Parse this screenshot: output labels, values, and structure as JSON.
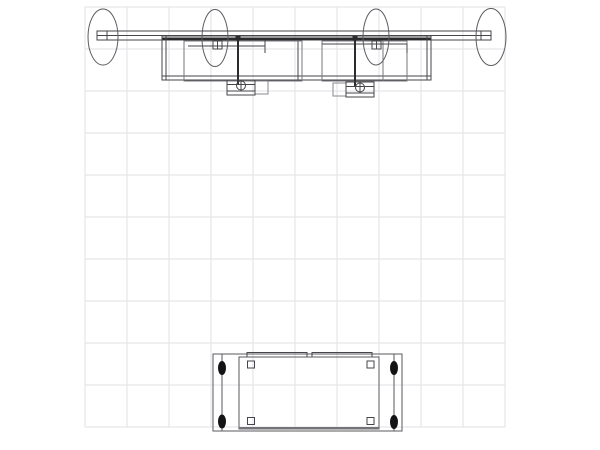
{
  "drawing": {
    "canvas": {
      "width": 600,
      "height": 450,
      "background": "#ffffff"
    },
    "grid": {
      "x0": 85,
      "y0": 7,
      "cols": 10,
      "rows": 10,
      "cell_size": 42,
      "line_color": "#e2e2e6"
    },
    "palette": {
      "default_stroke": "#46464a",
      "mid_stroke": "#5a5a5f",
      "light_stroke": "#8a8a90",
      "dark_fill": "#2b2b2e",
      "bolt_fill": "#131315"
    },
    "shapes": [
      {
        "name": "light-bar-outline",
        "type": "rect",
        "x": 97,
        "y": 31,
        "w": 394,
        "h": 9
      },
      {
        "name": "light-bar-mid-line",
        "type": "line",
        "x1": 97,
        "y1": 35.5,
        "x2": 491,
        "y2": 35.5
      },
      {
        "name": "light-bar-front-band",
        "type": "rect",
        "x": 162,
        "y": 37.4,
        "w": 269,
        "h": 2.4,
        "fill": "#2b2b2e",
        "stroke": "none"
      },
      {
        "name": "bar-end-cap-left",
        "type": "rect",
        "x": 97,
        "y": 31,
        "w": 10,
        "h": 9
      },
      {
        "name": "bar-end-cap-right",
        "type": "rect",
        "x": 481,
        "y": 31,
        "w": 10,
        "h": 9
      },
      {
        "name": "backwall-top-rect",
        "type": "rect",
        "x": 162,
        "y": 36,
        "w": 269,
        "h": 44
      },
      {
        "name": "backwall-left-inner-edge",
        "type": "line",
        "x1": 166,
        "y1": 36,
        "x2": 166,
        "y2": 80
      },
      {
        "name": "backwall-right-inner-edge",
        "type": "line",
        "x1": 427,
        "y1": 36,
        "x2": 427,
        "y2": 80
      },
      {
        "name": "backwall-bottom-inner-edge",
        "type": "line",
        "x1": 162,
        "y1": 76,
        "x2": 431,
        "y2": 76
      },
      {
        "name": "backwall-center-divider",
        "type": "line",
        "x1": 298,
        "y1": 40,
        "x2": 298,
        "y2": 80
      },
      {
        "name": "panel-left",
        "type": "rect",
        "x": 184,
        "y": 41,
        "w": 118,
        "h": 40,
        "stroke": "#77777c"
      },
      {
        "name": "panel-right",
        "type": "rect",
        "x": 322,
        "y": 41,
        "w": 85,
        "h": 40,
        "stroke": "#77777c"
      },
      {
        "name": "panel-right-inner-line",
        "type": "line",
        "x1": 383,
        "y1": 41,
        "x2": 383,
        "y2": 81,
        "stroke": "#77777c"
      },
      {
        "name": "light-arm-left",
        "type": "line",
        "x1": 188,
        "y1": 46,
        "x2": 265,
        "y2": 46
      },
      {
        "name": "light-arm-left-tick",
        "type": "line",
        "x1": 265,
        "y1": 40,
        "x2": 265,
        "y2": 53
      },
      {
        "name": "light-arm-right",
        "type": "line",
        "x1": 322,
        "y1": 44,
        "x2": 407,
        "y2": 44
      },
      {
        "name": "light-arm-right-tick",
        "type": "line",
        "x1": 407,
        "y1": 44,
        "x2": 407,
        "y2": 53
      },
      {
        "name": "bar-clamp-left",
        "type": "rect",
        "x": 213,
        "y": 41,
        "w": 9,
        "h": 8
      },
      {
        "name": "bar-clamp-left-jaw",
        "type": "line",
        "x1": 217.5,
        "y1": 41,
        "x2": 217.5,
        "y2": 49
      },
      {
        "name": "bar-clamp-right",
        "type": "rect",
        "x": 372,
        "y": 41,
        "w": 9,
        "h": 8
      },
      {
        "name": "bar-clamp-right-jaw",
        "type": "line",
        "x1": 376.5,
        "y1": 41,
        "x2": 376.5,
        "y2": 49
      },
      {
        "name": "light-stem-left",
        "type": "line",
        "x1": 238,
        "y1": 36,
        "x2": 238,
        "y2": 85,
        "stroke": "#2b2b2e",
        "sw": 2
      },
      {
        "name": "light-stem-right",
        "type": "line",
        "x1": 355,
        "y1": 36,
        "x2": 355,
        "y2": 87,
        "stroke": "#2b2b2e",
        "sw": 2
      },
      {
        "name": "stem-mount-left",
        "type": "rect",
        "x": 235.5,
        "y": 36,
        "w": 5,
        "h": 4.5,
        "fill": "#2b2b2e",
        "stroke": "none"
      },
      {
        "name": "stem-mount-right",
        "type": "rect",
        "x": 352.5,
        "y": 36,
        "w": 5,
        "h": 4.5,
        "fill": "#2b2b2e",
        "stroke": "none"
      },
      {
        "name": "light-head-left-housing",
        "type": "rect",
        "x": 255,
        "y": 81,
        "w": 13,
        "h": 13,
        "stroke": "#8a8a90"
      },
      {
        "name": "light-head-left-body",
        "type": "rect",
        "x": 227,
        "y": 80,
        "w": 28,
        "h": 15
      },
      {
        "name": "light-head-left-line-top",
        "type": "line",
        "x1": 227,
        "y1": 84.5,
        "x2": 255,
        "y2": 84.5
      },
      {
        "name": "light-head-left-line-bot",
        "type": "line",
        "x1": 227,
        "y1": 91,
        "x2": 255,
        "y2": 91
      },
      {
        "name": "light-head-left-lens",
        "type": "circle",
        "cx": 241,
        "cy": 85.5,
        "r": 4.5
      },
      {
        "name": "light-head-left-pin",
        "type": "line",
        "x1": 241,
        "y1": 81,
        "x2": 241,
        "y2": 90
      },
      {
        "name": "light-head-right-housing",
        "type": "rect",
        "x": 333,
        "y": 83,
        "w": 13,
        "h": 13,
        "stroke": "#8a8a90"
      },
      {
        "name": "light-head-right-body",
        "type": "rect",
        "x": 346,
        "y": 82,
        "w": 28,
        "h": 15
      },
      {
        "name": "light-head-right-line-top",
        "type": "line",
        "x1": 346,
        "y1": 86.5,
        "x2": 374,
        "y2": 86.5
      },
      {
        "name": "light-head-right-line-bot",
        "type": "line",
        "x1": 346,
        "y1": 93,
        "x2": 374,
        "y2": 93
      },
      {
        "name": "light-head-right-lens",
        "type": "circle",
        "cx": 360,
        "cy": 87.5,
        "r": 4.5
      },
      {
        "name": "light-head-right-pin",
        "type": "line",
        "x1": 360,
        "y1": 83,
        "x2": 360,
        "y2": 92
      },
      {
        "name": "light-ellipse-1",
        "type": "ellipse",
        "cx": 103,
        "cy": 37,
        "rx": 15,
        "ry": 28,
        "stroke": "#5a5a5f"
      },
      {
        "name": "light-ellipse-2",
        "type": "ellipse",
        "cx": 215,
        "cy": 38,
        "rx": 13,
        "ry": 28.5,
        "stroke": "#5a5a5f"
      },
      {
        "name": "light-ellipse-3",
        "type": "ellipse",
        "cx": 376,
        "cy": 37,
        "rx": 13,
        "ry": 28,
        "stroke": "#5a5a5f"
      },
      {
        "name": "light-ellipse-4",
        "type": "ellipse",
        "cx": 491,
        "cy": 37,
        "rx": 15,
        "ry": 28.5,
        "stroke": "#5a5a5f"
      },
      {
        "name": "counter-base-rect",
        "type": "rect",
        "x": 213,
        "y": 354,
        "w": 189,
        "h": 77,
        "stroke": "#5a5a5f"
      },
      {
        "name": "counter-top-panel-left",
        "type": "rect",
        "x": 247,
        "y": 352.5,
        "w": 60,
        "h": 4.5
      },
      {
        "name": "counter-top-panel-right",
        "type": "rect",
        "x": 312,
        "y": 352.5,
        "w": 60,
        "h": 4.5
      },
      {
        "name": "counter-top-rect",
        "type": "rect",
        "x": 239,
        "y": 357,
        "w": 140,
        "h": 72,
        "stroke": "#5a5a5f"
      },
      {
        "name": "counter-front-edge",
        "type": "line",
        "x1": 239,
        "y1": 428,
        "x2": 379,
        "y2": 428,
        "stroke": "#737378",
        "sw": 2.5
      },
      {
        "name": "counter-hinge-line-left",
        "type": "line",
        "x1": 222,
        "y1": 354,
        "x2": 222,
        "y2": 431,
        "stroke": "#5a5a5f"
      },
      {
        "name": "counter-hinge-line-right",
        "type": "line",
        "x1": 394,
        "y1": 354,
        "x2": 394,
        "y2": 431,
        "stroke": "#5a5a5f"
      },
      {
        "name": "counter-leg-top-left",
        "type": "rect",
        "x": 247.5,
        "y": 361,
        "w": 7,
        "h": 7
      },
      {
        "name": "counter-leg-top-right",
        "type": "rect",
        "x": 367,
        "y": 361,
        "w": 7,
        "h": 7
      },
      {
        "name": "counter-leg-bottom-left",
        "type": "rect",
        "x": 247.5,
        "y": 417.5,
        "w": 7,
        "h": 7
      },
      {
        "name": "counter-leg-bottom-right",
        "type": "rect",
        "x": 367,
        "y": 417.5,
        "w": 7,
        "h": 7
      },
      {
        "name": "counter-bolt-top-left",
        "type": "ellipse",
        "cx": 222,
        "cy": 368,
        "rx": 3.5,
        "ry": 6.5,
        "fill": "#131315",
        "stroke": "#131315"
      },
      {
        "name": "counter-bolt-bottom-left",
        "type": "ellipse",
        "cx": 222,
        "cy": 421.5,
        "rx": 3.5,
        "ry": 6.5,
        "fill": "#131315",
        "stroke": "#131315"
      },
      {
        "name": "counter-bolt-top-right",
        "type": "ellipse",
        "cx": 394,
        "cy": 368,
        "rx": 3.5,
        "ry": 6.5,
        "fill": "#131315",
        "stroke": "#131315"
      },
      {
        "name": "counter-bolt-bottom-right",
        "type": "ellipse",
        "cx": 394,
        "cy": 422,
        "rx": 3.5,
        "ry": 6.5,
        "fill": "#131315",
        "stroke": "#131315"
      }
    ]
  }
}
